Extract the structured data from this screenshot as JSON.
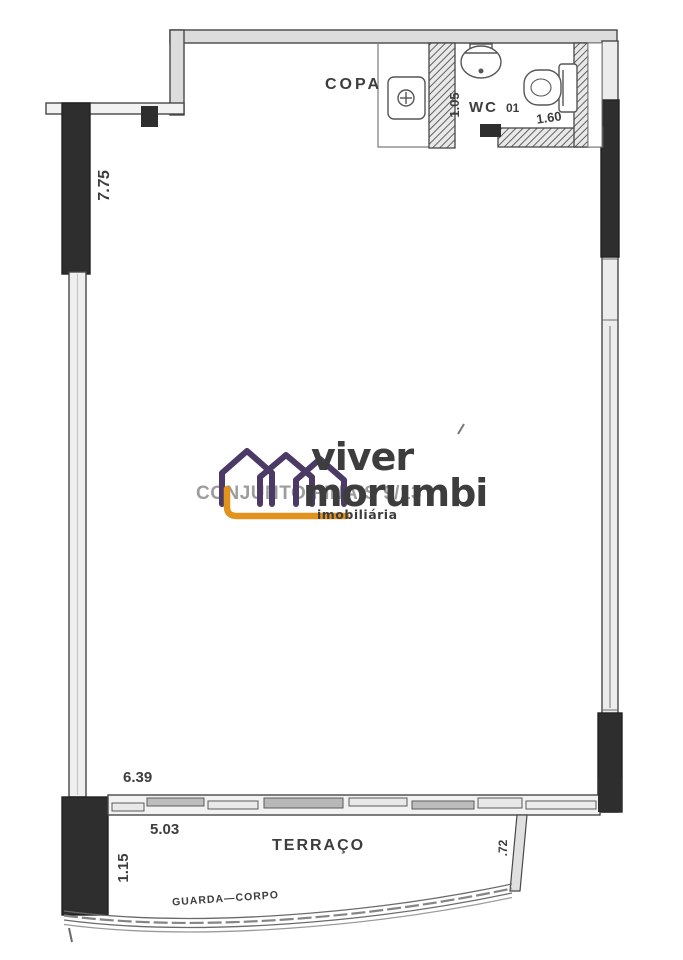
{
  "labels": {
    "copa": "COPA",
    "wc": "WC",
    "wc_number": "01",
    "terraco": "TERRAÇO",
    "guarda_corpo": "GUARDA—CORPO",
    "conjunto": "CONJUNTO FINAIS 9/13"
  },
  "dimensions": {
    "left_wall": "7.75",
    "wc_depth": "1.05",
    "wc_width": "1.60",
    "room_width": "6.39",
    "terrace_opening": "5.03",
    "terrace_left_depth": "1.15",
    "terrace_right_depth": ".72"
  },
  "watermark": {
    "brand_top": "viver",
    "brand_bottom": "morumbi",
    "tagline": "imobiliária",
    "purple": "#4b3a66",
    "orange": "#e2931d"
  },
  "colors": {
    "ink": "#474747",
    "wall_fill": "#dcdcdc",
    "solid_wall": "#2e2e2e",
    "dim_text": "#3d3d3d",
    "ghost_text": "#8d8d8d"
  }
}
